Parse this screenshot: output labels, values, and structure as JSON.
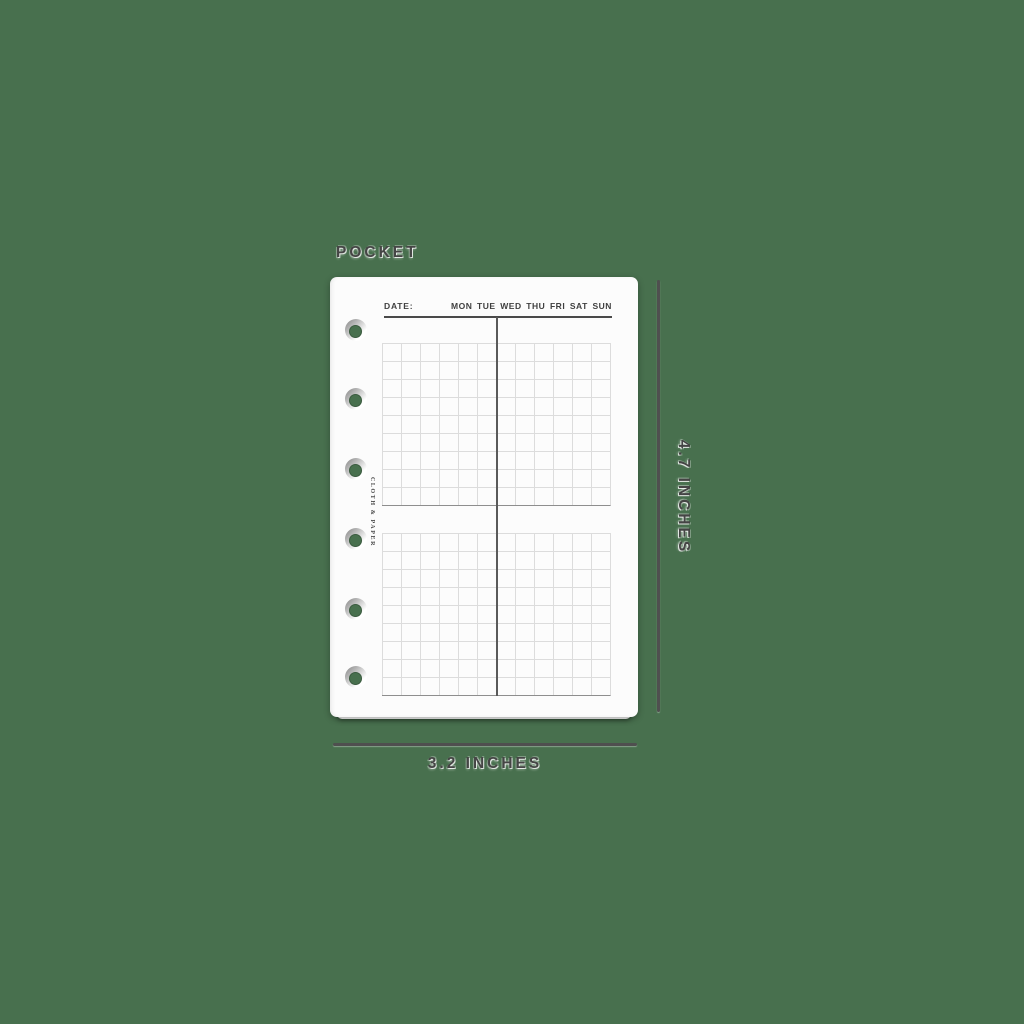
{
  "background": {
    "color": "#48704E"
  },
  "size_label": "POCKET",
  "dimensions": {
    "height": "4.7 INCHES",
    "width": "3.2 INCHES"
  },
  "page": {
    "brand": "CLOTH & PAPER",
    "date_label": "DATE:",
    "days": [
      "MON",
      "TUE",
      "WED",
      "THU",
      "FRI",
      "SAT",
      "SUN"
    ],
    "holes": 6,
    "grids": {
      "blocks": 2,
      "columns": 12,
      "rows": 9
    }
  },
  "colors": {
    "background_green": "#48704E",
    "paper": "#FCFCFC",
    "grid_line": "#DCDCDC",
    "grid_bottom_border": "#8E8E8E",
    "center_divider": "#5A5A5A",
    "header_ink": "#3F3F3F",
    "dimension_ink": "#4C4C4C"
  }
}
